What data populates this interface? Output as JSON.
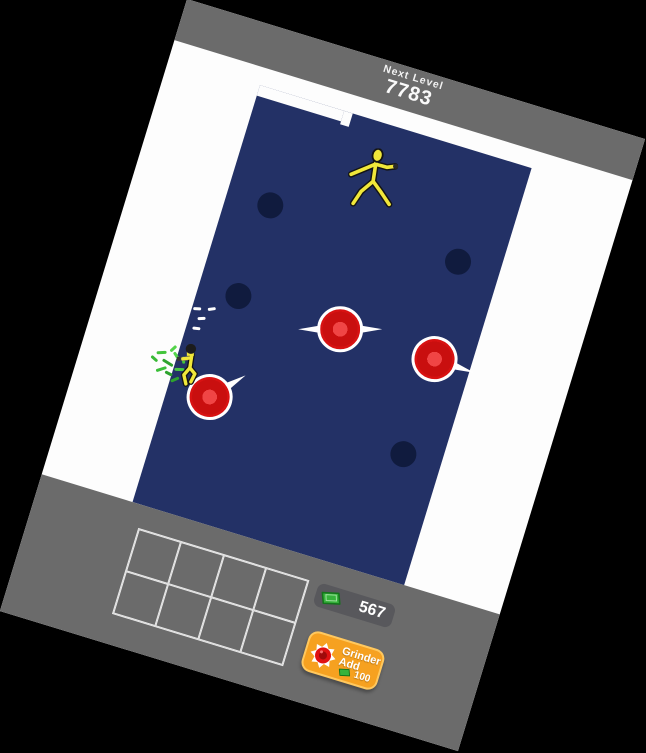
{
  "header": {
    "next_level_label": "Next Level",
    "next_level_value": "7783"
  },
  "hud": {
    "money_value": "567",
    "money_icon": "cash-icon",
    "buy_button": {
      "line1": "Grinder",
      "line2": "Add",
      "cost": "100",
      "icon": "grinder-icon"
    },
    "inventory": {
      "rows": 2,
      "cols": 4
    }
  },
  "arena": {
    "holes": [
      {
        "x": 140,
        "y": 173
      },
      {
        "x": 336,
        "y": 172
      },
      {
        "x": 136,
        "y": 269
      },
      {
        "x": 340,
        "y": 372
      }
    ],
    "grinders": [
      {
        "x": 243,
        "y": 271,
        "rot": -17,
        "blades": "both"
      },
      {
        "x": 342,
        "y": 272,
        "rot": 2,
        "blades": "right"
      },
      {
        "x": 138,
        "y": 374,
        "rot": -48,
        "blades": "right"
      }
    ],
    "enemy": {
      "x": 231,
      "y": 119,
      "type": "walking-mannequin"
    },
    "player": {
      "x": 110,
      "y": 350
    }
  },
  "effects": {
    "sparks": [
      {
        "x": 99,
        "y": 289,
        "rot": 75
      },
      {
        "x": 106,
        "y": 297,
        "rot": 70
      },
      {
        "x": 113,
        "y": 285,
        "rot": 65
      },
      {
        "x": 104,
        "y": 308,
        "rot": 80
      }
    ],
    "cash_burst": [
      {
        "x": 74,
        "y": 344,
        "w": 10,
        "rot": -20,
        "c": "#43c43b"
      },
      {
        "x": 82,
        "y": 352,
        "w": 12,
        "rot": 15,
        "c": "#2ea32e"
      },
      {
        "x": 90,
        "y": 343,
        "w": 9,
        "rot": 40,
        "c": "#53d44a"
      },
      {
        "x": 78,
        "y": 360,
        "w": 11,
        "rot": -35,
        "c": "#3bbf39"
      },
      {
        "x": 88,
        "y": 362,
        "w": 8,
        "rot": 10,
        "c": "#2ea32e"
      },
      {
        "x": 96,
        "y": 355,
        "w": 10,
        "rot": -15,
        "c": "#48ca41"
      },
      {
        "x": 70,
        "y": 352,
        "w": 8,
        "rot": 25,
        "c": "#39b936"
      },
      {
        "x": 95,
        "y": 366,
        "w": 9,
        "rot": -40,
        "c": "#2ea32e"
      },
      {
        "x": 99,
        "y": 345,
        "w": 7,
        "rot": 70,
        "c": "#43c43b"
      },
      {
        "x": 85,
        "y": 337,
        "w": 8,
        "rot": -60,
        "c": "#53d44a"
      }
    ]
  },
  "colors": {
    "ui_gray": "#6b6b6b",
    "field_navy": "#233166",
    "hole_navy": "#101b3e",
    "grinder_red": "#d81212",
    "accent_orange": "#f6a120",
    "cash_green": "#36b33b",
    "character_yellow": "#f0e73a"
  }
}
